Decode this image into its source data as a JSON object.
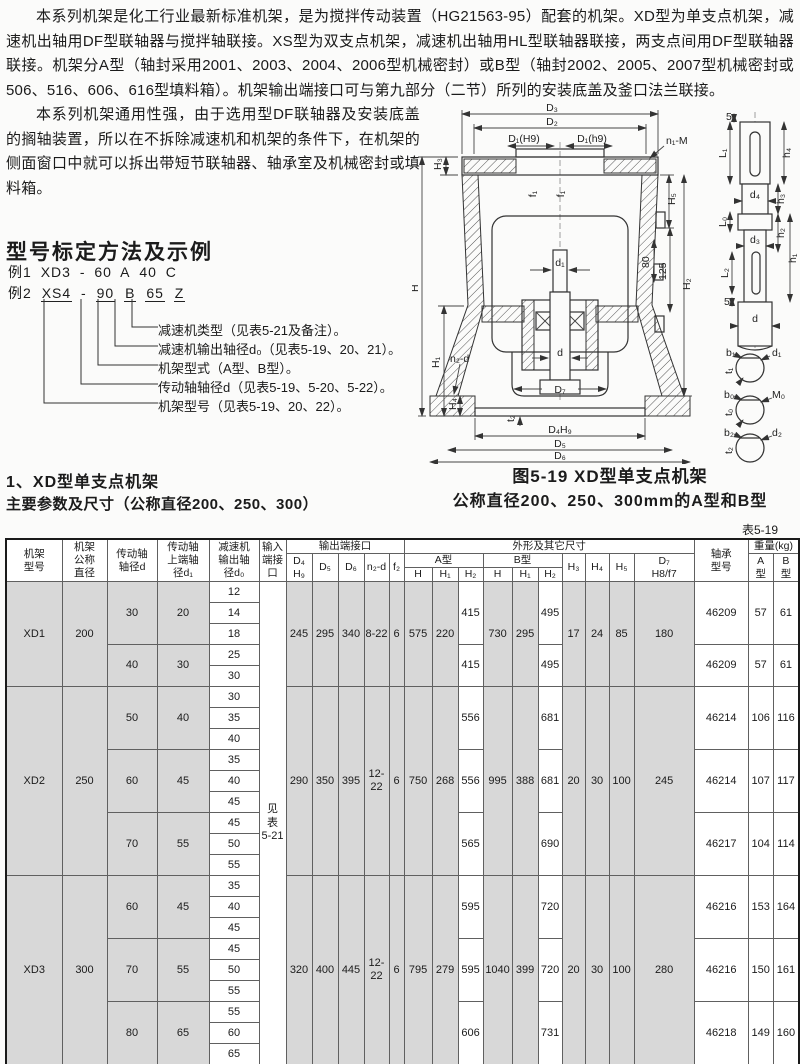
{
  "page": {
    "para1": "本系列机架是化工行业最新标准机架，是为搅拌传动装置（HG21563-95）配套的机架。XD型为单支点机架，减速机出轴用DF型联轴器与搅拌轴联接。XS型为双支点机架，减速机出轴用HL型联轴器联接，两支点间用DF型联轴器联接。机架分A型（轴封采用2001、2003、2004、2006型机械密封）或B型（轴封2002、2005、2007型机械密封或506、516、606、616型填料箱）。机架输出端接口可与第九部分（二节）所列的安装底盖及釜口法兰联接。",
    "para2": "本系列机架通用性强，由于选用型DF联轴器及安装底盖的搁轴装置，所以在不拆除减速机和机架的条件下，在机架的侧面窗口中就可以拆出带短节联轴器、轴承室及机械密封或填料箱。"
  },
  "designation": {
    "heading": "型号标定方法及示例",
    "example1": {
      "prefix": "例1",
      "parts": [
        "XD3",
        "-",
        "60",
        "A",
        "40",
        "C"
      ]
    },
    "example2": {
      "prefix": "例2",
      "parts": [
        "XS4",
        "-",
        "90",
        "B",
        "65",
        "Z"
      ]
    },
    "callouts": [
      "减速机类型（见表5-21及备注）。",
      "减速机输出轴径d₀（见表5-19、20、21）。",
      "机架型式（A型、B型）。",
      "传动轴轴径d（见表5-19、5-20、5-22）。",
      "机架型号（见表5-19、20、22）。"
    ]
  },
  "figure": {
    "caption_line1": "图5-19 XD型单支点机架",
    "caption_line2": "公称直径200、250、300mm的A型和B型",
    "labels": {
      "D3": "D₃",
      "D2": "D₂",
      "D1H9": "D₁(H9)",
      "D1h9": "D₁(h9)",
      "n1M": "n₁-M",
      "H3": "H₃",
      "H": "H",
      "H1": "H₁",
      "n2d": "n₂-d",
      "H4": "H₄",
      "H5": "H₅",
      "dim80": "80",
      "dim125": "125",
      "H2": "H₂",
      "f1": "f₁",
      "d1": "d₁",
      "d": "d",
      "D7": "D₇",
      "t2": "t₂",
      "D4H9": "D₄H₉",
      "D5": "D₅",
      "D6": "D₆"
    },
    "shaft_labels": {
      "dim5": "5",
      "L1": "L₁",
      "h4": "h₄",
      "d4": "d₄",
      "h3": "h₃",
      "L0": "L₀",
      "d3": "d₃",
      "h2": "h₂",
      "h1": "h₁",
      "L2": "L₂",
      "d": "d",
      "b1": "b₁",
      "d1": "d₁",
      "t1": "t₁",
      "b0": "b₀",
      "M0": "M₀",
      "t0": "t₀",
      "b2": "b₂",
      "d2": "d₂",
      "t2": "t₂"
    }
  },
  "section": {
    "title": "1、XD型单支点机架",
    "subtitle": "主要参数及尺寸（公称直径200、250、300）",
    "table_ref": "表5-19"
  },
  "table": {
    "col_widths": [
      56,
      45,
      50,
      52,
      50,
      27,
      26,
      26,
      26,
      25,
      15,
      28,
      26,
      25,
      29,
      26,
      24,
      23,
      24,
      25,
      60,
      54,
      25,
      26
    ],
    "header_rows": [
      [
        [
          "机架\n型号",
          3,
          1
        ],
        [
          "机架\n公称\n直径",
          3,
          1
        ],
        [
          "传动轴\n轴径d",
          3,
          1
        ],
        [
          "传动轴\n上端轴\n径d₁",
          3,
          1
        ],
        [
          "减速机\n输出轴\n径d₀",
          3,
          1
        ],
        [
          "输入\n端接\n口",
          3,
          1
        ],
        [
          "输出端接口",
          1,
          5
        ],
        [
          "外形及其它尺寸",
          1,
          10
        ],
        [
          "轴承\n型号",
          3,
          1
        ],
        [
          "重量(kg)",
          1,
          2
        ]
      ],
      [
        [
          "D₄\nH₉",
          2,
          1
        ],
        [
          "D₅",
          2,
          1
        ],
        [
          "D₆",
          2,
          1
        ],
        [
          "n₂-d",
          2,
          1
        ],
        [
          "f₂",
          2,
          1
        ],
        [
          "A型",
          1,
          3
        ],
        [
          "B型",
          1,
          3
        ],
        [
          "H₃",
          2,
          1
        ],
        [
          "H₄",
          2,
          1
        ],
        [
          "H₅",
          2,
          1
        ],
        [
          "D₇\nH8/f7",
          2,
          1
        ],
        [
          "A\n型",
          2,
          1
        ],
        [
          "B\n型",
          2,
          1
        ]
      ],
      [
        [
          "H",
          1,
          1
        ],
        [
          "H₁",
          1,
          1
        ],
        [
          "H₂",
          1,
          1
        ],
        [
          "H",
          1,
          1
        ],
        [
          "H₁",
          1,
          1
        ],
        [
          "H₂",
          1,
          1
        ]
      ]
    ],
    "rows": [
      [
        [
          "XD1",
          5,
          "g"
        ],
        [
          "200",
          5,
          "g"
        ],
        [
          "30",
          3,
          "g"
        ],
        [
          "20",
          3,
          "g"
        ],
        "12",
        [
          "见\n表\n5-21",
          23,
          "w"
        ],
        [
          "245",
          5,
          "g"
        ],
        [
          "295",
          5,
          "g"
        ],
        [
          "340",
          5,
          "g"
        ],
        [
          "8-22",
          5,
          "g"
        ],
        [
          "6",
          5,
          "g"
        ],
        [
          "575",
          5,
          "g"
        ],
        [
          "220",
          5,
          "g"
        ],
        [
          "415",
          3,
          "w"
        ],
        [
          "730",
          5,
          "g"
        ],
        [
          "295",
          5,
          "g"
        ],
        [
          "495",
          3,
          "w"
        ],
        [
          "17",
          5,
          "g"
        ],
        [
          "24",
          5,
          "g"
        ],
        [
          "85",
          5,
          "g"
        ],
        [
          "180",
          5,
          "g"
        ],
        [
          "46209",
          3,
          "w"
        ],
        [
          "57",
          3,
          "w"
        ],
        [
          "61",
          3,
          "w"
        ]
      ],
      [
        "14"
      ],
      [
        "18"
      ],
      [
        [
          "40",
          2,
          "g"
        ],
        [
          "30",
          2,
          "g"
        ],
        "25",
        [
          "415",
          2,
          "w"
        ],
        [
          "495",
          2,
          "w"
        ],
        [
          "46209",
          2,
          "w"
        ],
        [
          "57",
          2,
          "w"
        ],
        [
          "61",
          2,
          "w"
        ]
      ],
      [
        "30"
      ],
      [
        [
          "XD2",
          9,
          "g"
        ],
        [
          "250",
          9,
          "g"
        ],
        [
          "50",
          3,
          "g"
        ],
        [
          "40",
          3,
          "g"
        ],
        "30",
        [
          "290",
          9,
          "g"
        ],
        [
          "350",
          9,
          "g"
        ],
        [
          "395",
          9,
          "g"
        ],
        [
          "12-22",
          9,
          "g"
        ],
        [
          "6",
          9,
          "g"
        ],
        [
          "750",
          9,
          "g"
        ],
        [
          "268",
          9,
          "g"
        ],
        [
          "556",
          3,
          "w"
        ],
        [
          "995",
          9,
          "g"
        ],
        [
          "388",
          9,
          "g"
        ],
        [
          "681",
          3,
          "w"
        ],
        [
          "20",
          9,
          "g"
        ],
        [
          "30",
          9,
          "g"
        ],
        [
          "100",
          9,
          "g"
        ],
        [
          "245",
          9,
          "g"
        ],
        [
          "46214",
          3,
          "w"
        ],
        [
          "106",
          3,
          "w"
        ],
        [
          "116",
          3,
          "w"
        ]
      ],
      [
        "35"
      ],
      [
        "40"
      ],
      [
        [
          "60",
          3,
          "g"
        ],
        [
          "45",
          3,
          "g"
        ],
        "35",
        [
          "556",
          3,
          "w"
        ],
        [
          "681",
          3,
          "w"
        ],
        [
          "46214",
          3,
          "w"
        ],
        [
          "107",
          3,
          "w"
        ],
        [
          "117",
          3,
          "w"
        ]
      ],
      [
        "40"
      ],
      [
        "45"
      ],
      [
        [
          "70",
          3,
          "g"
        ],
        [
          "55",
          3,
          "g"
        ],
        "45",
        [
          "565",
          3,
          "w"
        ],
        [
          "690",
          3,
          "w"
        ],
        [
          "46217",
          3,
          "w"
        ],
        [
          "104",
          3,
          "w"
        ],
        [
          "114",
          3,
          "w"
        ]
      ],
      [
        "50"
      ],
      [
        "55"
      ],
      [
        [
          "XD3",
          9,
          "g"
        ],
        [
          "300",
          9,
          "g"
        ],
        [
          "60",
          3,
          "g"
        ],
        [
          "45",
          3,
          "g"
        ],
        "35",
        [
          "320",
          9,
          "g"
        ],
        [
          "400",
          9,
          "g"
        ],
        [
          "445",
          9,
          "g"
        ],
        [
          "12-22",
          9,
          "g"
        ],
        [
          "6",
          9,
          "g"
        ],
        [
          "795",
          9,
          "g"
        ],
        [
          "279",
          9,
          "g"
        ],
        [
          "595",
          3,
          "w"
        ],
        [
          "1040",
          9,
          "g"
        ],
        [
          "399",
          9,
          "g"
        ],
        [
          "720",
          3,
          "w"
        ],
        [
          "20",
          9,
          "g"
        ],
        [
          "30",
          9,
          "g"
        ],
        [
          "100",
          9,
          "g"
        ],
        [
          "280",
          9,
          "g"
        ],
        [
          "46216",
          3,
          "w"
        ],
        [
          "153",
          3,
          "w"
        ],
        [
          "164",
          3,
          "w"
        ]
      ],
      [
        "40"
      ],
      [
        "45"
      ],
      [
        [
          "70",
          3,
          "g"
        ],
        [
          "55",
          3,
          "g"
        ],
        "45",
        [
          "595",
          3,
          "w"
        ],
        [
          "720",
          3,
          "w"
        ],
        [
          "46216",
          3,
          "w"
        ],
        [
          "150",
          3,
          "w"
        ],
        [
          "161",
          3,
          "w"
        ]
      ],
      [
        "50"
      ],
      [
        "55"
      ],
      [
        [
          "80",
          3,
          "g"
        ],
        [
          "65",
          3,
          "g"
        ],
        "55",
        [
          "606",
          3,
          "w"
        ],
        [
          "731",
          3,
          "w"
        ],
        [
          "46218",
          3,
          "w"
        ],
        [
          "149",
          3,
          "w"
        ],
        [
          "160",
          3,
          "w"
        ]
      ],
      [
        "60"
      ],
      [
        "65"
      ]
    ]
  }
}
